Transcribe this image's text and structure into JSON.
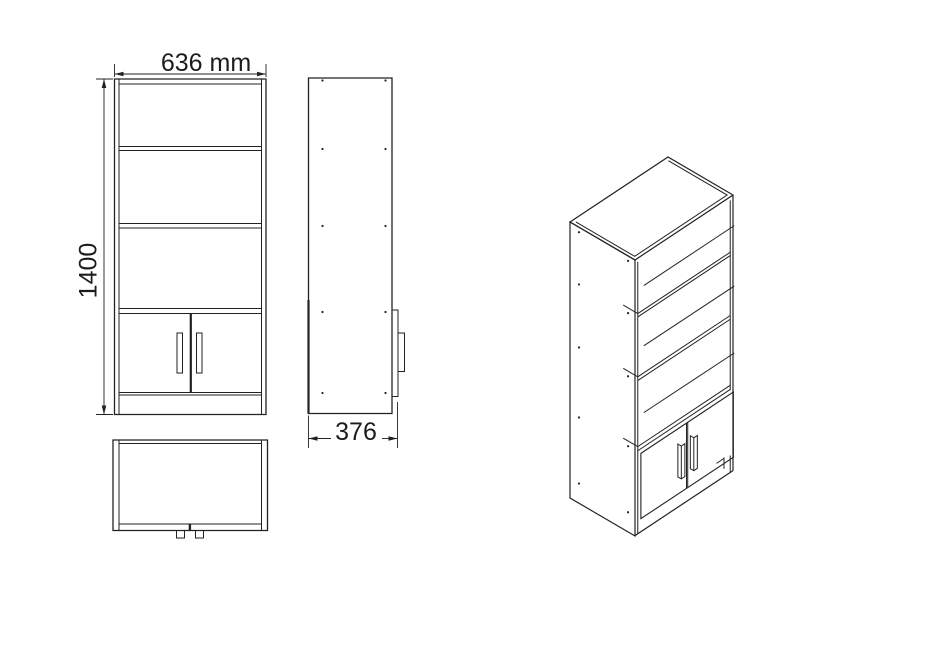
{
  "diagram": {
    "subject": "bookcase-cabinet-technical-drawing",
    "dimensions": {
      "width_label": "636 mm",
      "height_label": "1400",
      "depth_label": "376",
      "width_mm": 636,
      "height_mm": 1400,
      "depth_mm": 376
    },
    "views": {
      "front": "front-view",
      "side": "side-view",
      "top": "top-view",
      "isometric": "isometric-view"
    },
    "colors": {
      "line": "#222222",
      "background": "#ffffff"
    }
  }
}
